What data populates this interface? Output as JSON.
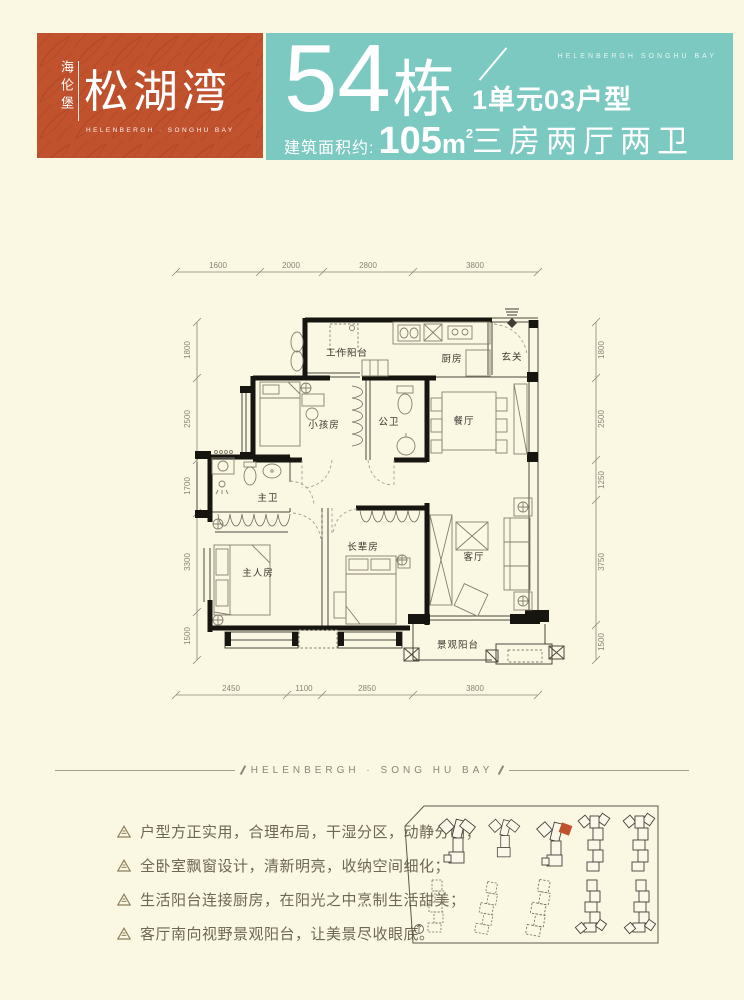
{
  "colors": {
    "cream_bg": "#FAF7E3",
    "brand_red": "#C0522E",
    "brand_teal": "#7CC9C2",
    "text_brown": "#6E6852"
  },
  "brand": {
    "vertical_name": "海伦堡",
    "main_name": "松湖湾",
    "sub_en": "HELENBERGH · SONGHU BAY"
  },
  "header": {
    "building_number": "54",
    "building_suffix": "栋",
    "unit_label": "1单元03户型",
    "area_prefix": "建筑面积约:",
    "area_value": "105",
    "area_unit": "m",
    "area_exponent": "2",
    "layout_label": "三房两厅两卫",
    "brand_en": "HELENBERGH SONGHU BAY"
  },
  "floorplan": {
    "rooms": [
      {
        "label": "工作阳台"
      },
      {
        "label": "厨房"
      },
      {
        "label": "玄关"
      },
      {
        "label": "小孩房"
      },
      {
        "label": "公卫"
      },
      {
        "label": "餐厅"
      },
      {
        "label": "主卫"
      },
      {
        "label": "主人房"
      },
      {
        "label": "长辈房"
      },
      {
        "label": "客厅"
      },
      {
        "label": "景观阳台"
      }
    ],
    "dims": {
      "top": [
        "1600",
        "2000",
        "2800",
        "3800"
      ],
      "bottom": [
        "2450",
        "1100",
        "2850",
        "3800"
      ],
      "left": [
        "1800",
        "2500",
        "1700",
        "3300",
        "1500"
      ],
      "right": [
        "1800",
        "2500",
        "1250",
        "3750",
        "1500"
      ]
    }
  },
  "divider": {
    "text": "HELENBERGH · SONG HU BAY"
  },
  "features": [
    "户型方正实用，合理布局，干湿分区，动静分明；",
    "全卧室飘窗设计，清新明亮，收纳空间细化；",
    "生活阳台连接厨房，在阳光之中烹制生活甜美；",
    "客厅南向视野景观阳台，让美景尽收眼底。"
  ]
}
